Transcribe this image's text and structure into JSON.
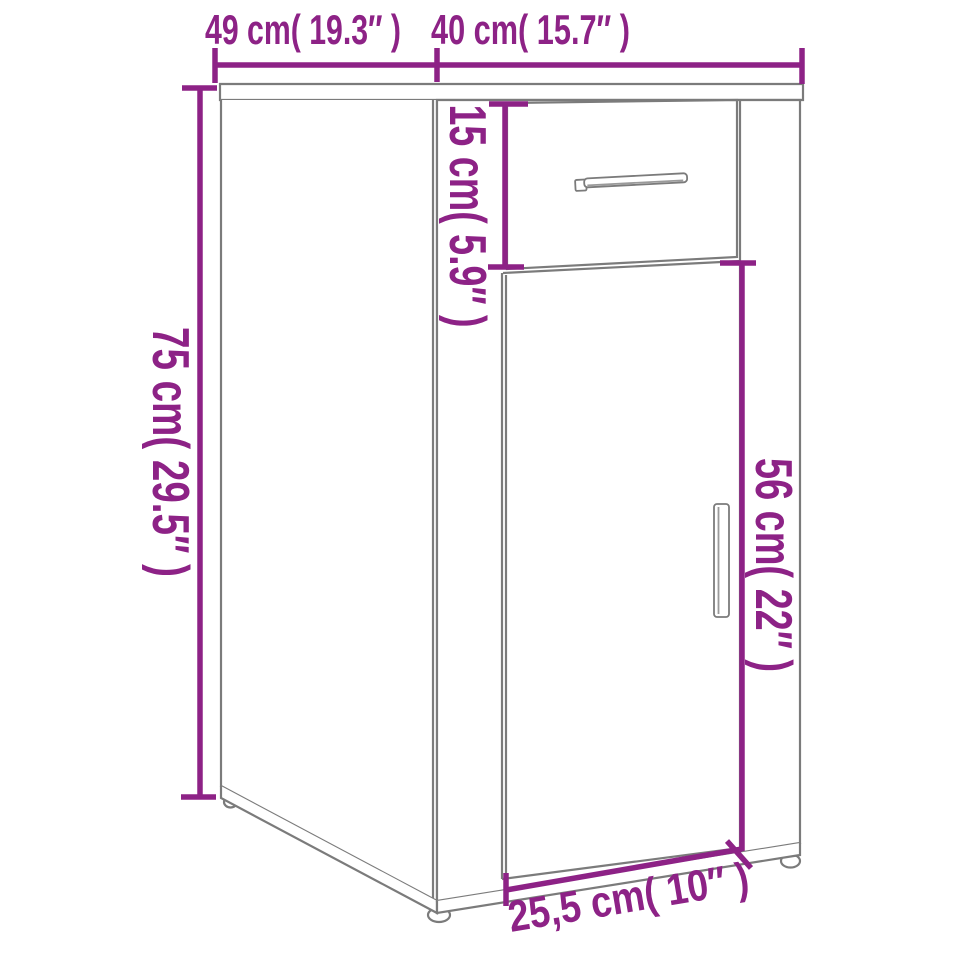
{
  "diagram": {
    "type": "product-dimension-line-drawing",
    "subject": "desk cabinet with one drawer and one door, three-quarter perspective view",
    "colors": {
      "dimension_accent": "#8D2286",
      "artwork_line": "#7b7b7b",
      "background": "#ffffff"
    },
    "labels": {
      "top_width": "49 cm( 19.3″ )",
      "top_depth": "40 cm( 15.7″ )",
      "height": "75 cm( 29.5″ )",
      "drawer_height": "15 cm( 5.9″ )",
      "door_height": "56 cm( 22″ )",
      "bottom_depth": "25,5 cm( 10″ )"
    },
    "measurements": [
      {
        "name": "side panel width",
        "cm": "49",
        "inch": "19.3"
      },
      {
        "name": "front width",
        "cm": "40",
        "inch": "15.7"
      },
      {
        "name": "overall height",
        "cm": "75",
        "inch": "29.5"
      },
      {
        "name": "drawer front height",
        "cm": "15",
        "inch": "5.9"
      },
      {
        "name": "door height",
        "cm": "56",
        "inch": "22"
      },
      {
        "name": "bottom front depth",
        "cm": "25,5",
        "inch": "10"
      }
    ]
  }
}
